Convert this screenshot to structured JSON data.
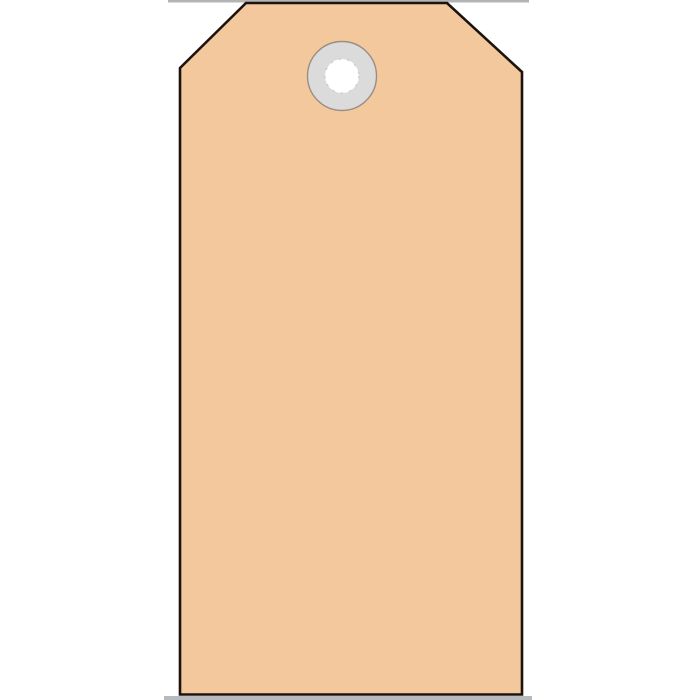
{
  "page": {
    "background_color": "#ffffff"
  },
  "tag": {
    "body_fill": "#f3c89c",
    "outline_color": "#1c130e",
    "eyelet": {
      "ring_fill": "#dbdbdb",
      "ring_border_color": "#9a8e85",
      "hole_fill": "#ffffff",
      "hole_edge_color": "#cfc9c4"
    }
  },
  "artifacts": {
    "top_edge_line_color": "#b4b4b4",
    "bottom_strip_color": "#b6bbbf"
  }
}
